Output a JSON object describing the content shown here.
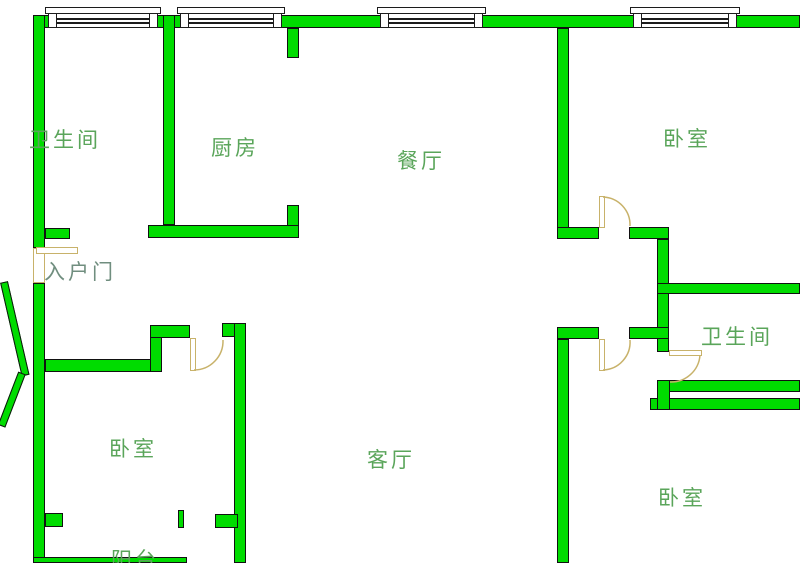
{
  "app": {
    "type": "apartment-floor-plan"
  },
  "colors": {
    "wall": "#00dc00",
    "wall_border": "#111111",
    "door": "#c8b26a",
    "window_border": "#1c1c1c",
    "label": "#5aa55a",
    "entrance_label": "#708e7f"
  },
  "rooms": [
    {
      "id": "bathroom-top-left",
      "label": "卫生间",
      "x": 29,
      "y": 124
    },
    {
      "id": "kitchen",
      "label": "厨房",
      "x": 211,
      "y": 132
    },
    {
      "id": "dining-room",
      "label": "餐厅",
      "x": 397,
      "y": 145
    },
    {
      "id": "bedroom-top-right",
      "label": "卧室",
      "x": 663,
      "y": 123
    },
    {
      "id": "entrance-door",
      "label": "入户门",
      "x": 44,
      "y": 256,
      "color": "#708e7f"
    },
    {
      "id": "bathroom-right",
      "label": "卫生间",
      "x": 701,
      "y": 321
    },
    {
      "id": "bedroom-bottom-left",
      "label": "卧室",
      "x": 109,
      "y": 433
    },
    {
      "id": "living-room",
      "label": "客厅",
      "x": 367,
      "y": 444
    },
    {
      "id": "bedroom-bottom-right",
      "label": "卧室",
      "x": 658,
      "y": 482
    },
    {
      "id": "balcony",
      "label": "阳台",
      "x": 111,
      "y": 544
    }
  ],
  "plan": {
    "width": 800,
    "height": 563,
    "walls": [
      {
        "x": 33,
        "y": 15,
        "w": 767,
        "h": 13
      },
      {
        "x": 33,
        "y": 15,
        "w": 12,
        "h": 233
      },
      {
        "x": 33,
        "y": 283,
        "w": 12,
        "h": 280
      },
      {
        "x": 163,
        "y": 15,
        "w": 12,
        "h": 210
      },
      {
        "x": 287,
        "y": 28,
        "w": 12,
        "h": 30
      },
      {
        "x": 287,
        "y": 205,
        "w": 12,
        "h": 22
      },
      {
        "x": 148,
        "y": 225,
        "w": 151,
        "h": 13
      },
      {
        "x": 45,
        "y": 228,
        "w": 25,
        "h": 11
      },
      {
        "x": 557,
        "y": 28,
        "w": 12,
        "h": 200
      },
      {
        "x": 557,
        "y": 227,
        "w": 42,
        "h": 12
      },
      {
        "x": 629,
        "y": 227,
        "w": 40,
        "h": 12
      },
      {
        "x": 657,
        "y": 239,
        "w": 12,
        "h": 113
      },
      {
        "x": 657,
        "y": 283,
        "w": 143,
        "h": 11
      },
      {
        "x": 557,
        "y": 327,
        "w": 42,
        "h": 12
      },
      {
        "x": 629,
        "y": 327,
        "w": 40,
        "h": 12
      },
      {
        "x": 557,
        "y": 339,
        "w": 12,
        "h": 224
      },
      {
        "x": 657,
        "y": 380,
        "w": 143,
        "h": 12
      },
      {
        "x": 650,
        "y": 398,
        "w": 150,
        "h": 12
      },
      {
        "x": 657,
        "y": 380,
        "w": 13,
        "h": 30
      },
      {
        "x": 45,
        "y": 359,
        "w": 117,
        "h": 13
      },
      {
        "x": 150,
        "y": 325,
        "w": 12,
        "h": 47
      },
      {
        "x": 150,
        "y": 325,
        "w": 40,
        "h": 13
      },
      {
        "x": 222,
        "y": 323,
        "w": 24,
        "h": 14
      },
      {
        "x": 234,
        "y": 323,
        "w": 12,
        "h": 240
      },
      {
        "x": 45,
        "y": 513,
        "w": 18,
        "h": 14
      },
      {
        "x": 215,
        "y": 514,
        "w": 23,
        "h": 14
      },
      {
        "x": 178,
        "y": 510,
        "w": 6,
        "h": 18
      },
      {
        "x": 33,
        "y": 557,
        "w": 154,
        "h": 6
      }
    ],
    "windows": [
      {
        "x": 48,
        "w": 110
      },
      {
        "x": 180,
        "w": 102
      },
      {
        "x": 380,
        "w": 103
      },
      {
        "x": 633,
        "w": 104
      }
    ],
    "door_panels": [
      {
        "name": "entry-door-opening",
        "x": 33,
        "y": 248,
        "w": 12,
        "h": 35
      },
      {
        "name": "entry-door-panel",
        "x": 36,
        "y": 247,
        "w": 42,
        "h": 7
      },
      {
        "name": "bedroom-bl-door-panel",
        "x": 190,
        "y": 338,
        "w": 6,
        "h": 33
      },
      {
        "name": "bedroom-tr-door-panel",
        "x": 599,
        "y": 196,
        "w": 6,
        "h": 32
      },
      {
        "name": "bedroom-br-door-panel",
        "x": 599,
        "y": 339,
        "w": 6,
        "h": 32
      },
      {
        "name": "bathroom-door-panel",
        "x": 669,
        "y": 350,
        "w": 33,
        "h": 6
      }
    ],
    "door_arcs": [
      {
        "name": "bedroom-bl-door-arc",
        "d": "M 194 370 A 29 29 0 0 0 223 340"
      },
      {
        "name": "bedroom-tr-door-arc",
        "d": "M 603 197 A 28 28 0 0 1 630 226"
      },
      {
        "name": "bedroom-br-door-arc",
        "d": "M 603 370 A 28 28 0 0 0 630 340"
      },
      {
        "name": "bathroom-door-arc",
        "d": "M 700 355 A 29 29 0 0 1 670 382"
      }
    ],
    "diagonals": [
      {
        "x": 0,
        "y": 282,
        "w": 8,
        "h": 96,
        "rot": -13
      },
      {
        "x": 18,
        "y": 373,
        "w": 8,
        "h": 57,
        "rot": 21
      }
    ]
  }
}
